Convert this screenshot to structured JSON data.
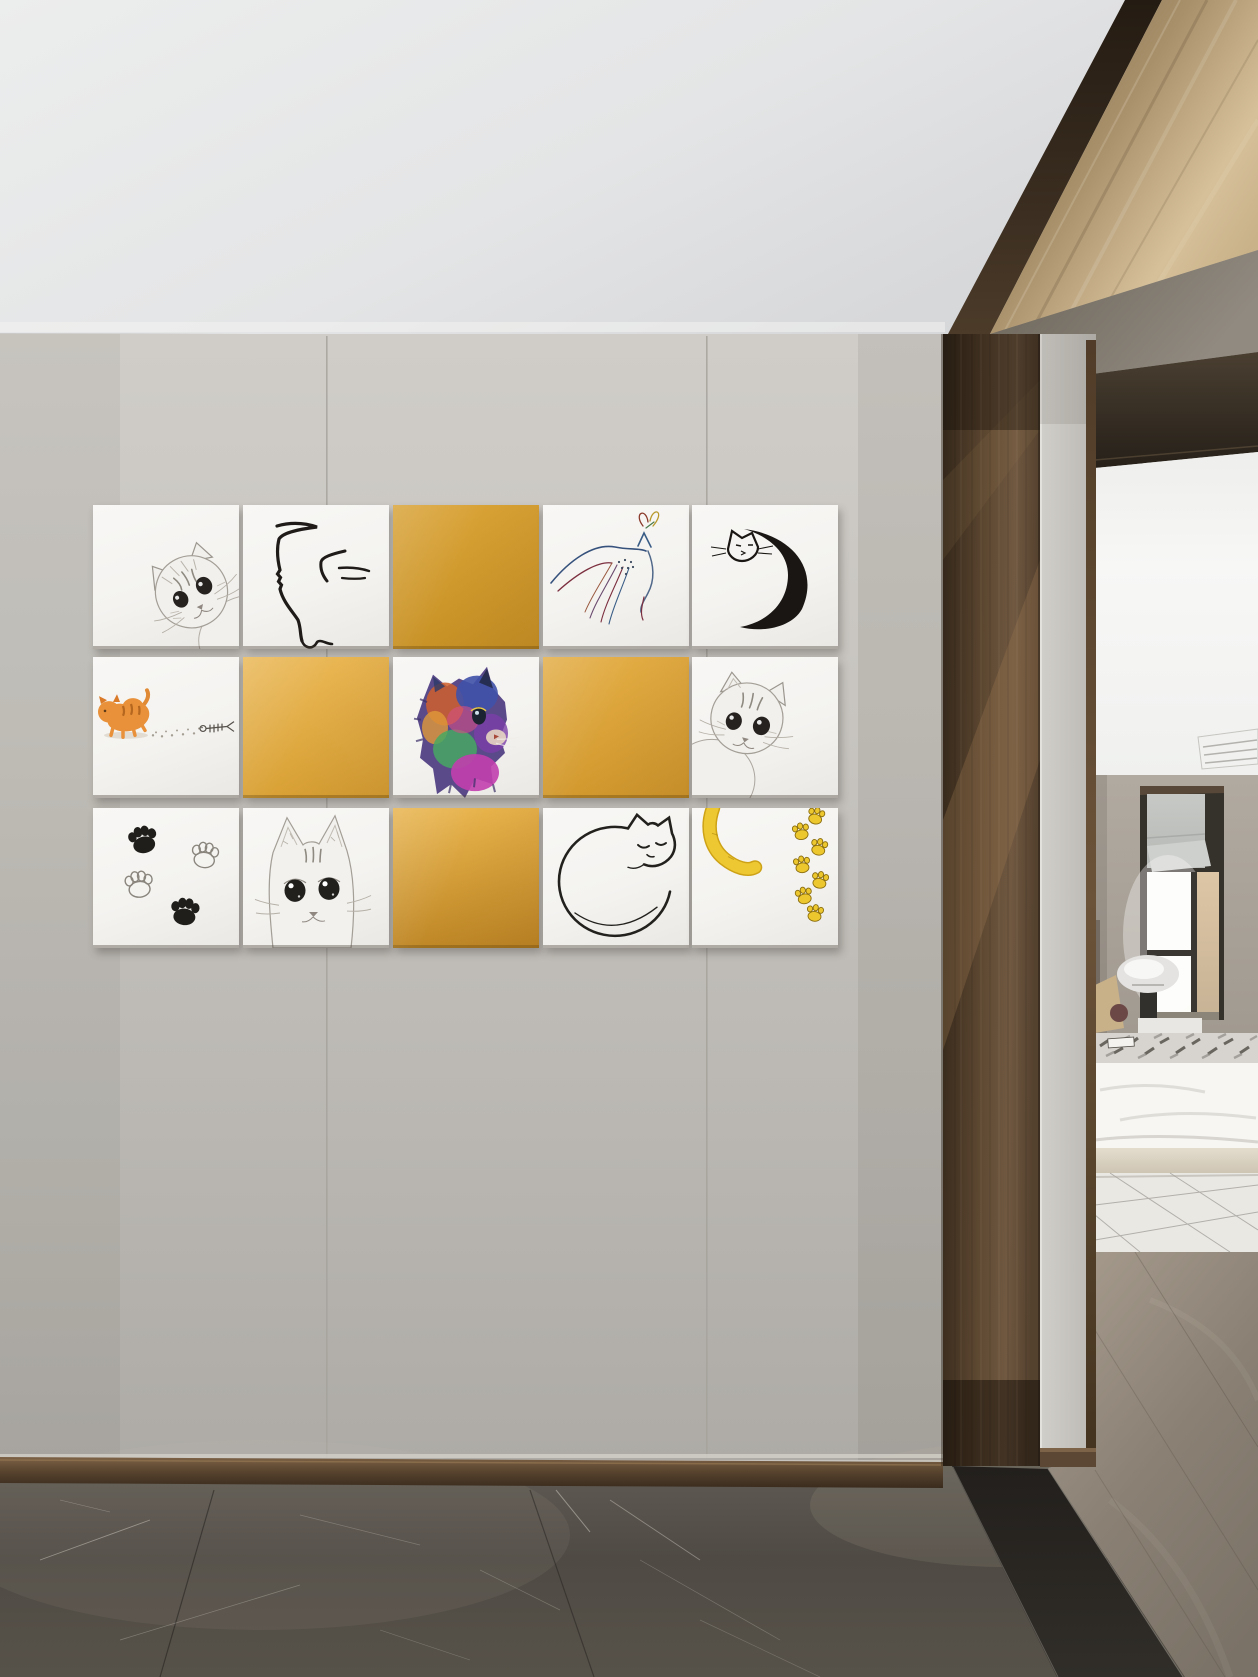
{
  "palette": {
    "wall": "#c6c3be",
    "ceiling": "#e9eaec",
    "accent_yellow": "#e0a83e",
    "bronze": "#6e5740",
    "bronze_dark": "#3a2d20",
    "marble_floor": "#534e48",
    "threshold_black": "#26231f",
    "wood_floor": "#8d8276",
    "bedroom_wall": "#aaa49c",
    "white_tile": "#f5f4f1",
    "line_ink": "#1e1b18",
    "sketch_gray": "#8f8a82",
    "rug": "#eae8e3",
    "duvet": "#f7f6f3"
  },
  "art_wall": {
    "grid": {
      "cols_x": [
        93,
        243,
        393,
        543,
        692
      ],
      "rows_y": [
        505,
        657,
        808
      ],
      "tile_w": 146,
      "row_h": [
        144,
        141,
        140
      ]
    },
    "tiles": [
      {
        "id": "r1c1",
        "row": 0,
        "col": 0,
        "type": "art",
        "art": "sketch-cat-corner",
        "label": "pencil sketch kitten peeking from corner"
      },
      {
        "id": "r1c2",
        "row": 0,
        "col": 1,
        "type": "art",
        "art": "line-cat-profile",
        "label": "minimal ink cat profile"
      },
      {
        "id": "r1c3",
        "row": 0,
        "col": 2,
        "type": "solid",
        "fill_top": "#d8a134",
        "fill_bottom": "#c89226",
        "label": "solid amber tile"
      },
      {
        "id": "r1c4",
        "row": 0,
        "col": 3,
        "type": "art",
        "art": "rainbow-line-cat-butterfly",
        "label": "colored line cat watching butterfly"
      },
      {
        "id": "r1c5",
        "row": 0,
        "col": 4,
        "type": "art",
        "art": "crescent-cat",
        "label": "cat curled as crescent moon"
      },
      {
        "id": "r2c1",
        "row": 1,
        "col": 0,
        "type": "art",
        "art": "orange-kitten-fish",
        "label": "orange kitten with paw trail to fish bone"
      },
      {
        "id": "r2c2",
        "row": 1,
        "col": 1,
        "type": "solid",
        "fill_top": "#e9b653",
        "fill_bottom": "#d9a135",
        "label": "solid amber tile"
      },
      {
        "id": "r2c3",
        "row": 1,
        "col": 2,
        "type": "art",
        "art": "rainbow-watercolor-kitten",
        "label": "rainbow watercolor kitten"
      },
      {
        "id": "r2c4",
        "row": 1,
        "col": 3,
        "type": "solid",
        "fill_top": "#e2ab42",
        "fill_bottom": "#d2992e",
        "label": "solid amber tile"
      },
      {
        "id": "r2c5",
        "row": 1,
        "col": 4,
        "type": "art",
        "art": "sketch-cat-peek-left",
        "label": "pencil sketch cat tilting head"
      },
      {
        "id": "r3c1",
        "row": 2,
        "col": 0,
        "type": "art",
        "art": "paw-prints-black",
        "label": "black and outline paw prints"
      },
      {
        "id": "r3c2",
        "row": 2,
        "col": 1,
        "type": "art",
        "art": "sketch-cat-bottom",
        "label": "pencil sketch cat rising from edge"
      },
      {
        "id": "r3c3",
        "row": 2,
        "col": 2,
        "type": "solid",
        "fill_top": "#e7b24a",
        "fill_bottom": "#bf8726",
        "label": "solid amber tile"
      },
      {
        "id": "r3c4",
        "row": 2,
        "col": 3,
        "type": "art",
        "art": "curled-sleeping-cat",
        "label": "line art sleeping cat curled in circle"
      },
      {
        "id": "r3c5",
        "row": 2,
        "col": 4,
        "type": "art",
        "art": "yellow-tail-paws",
        "label": "yellow tail and paw print trail"
      }
    ]
  },
  "scene": {
    "wall_panel_seams": 2,
    "elements": [
      "white ceiling",
      "bronze ceiling beam",
      "gray wall panels",
      "bronze pilaster",
      "door jamb",
      "door soffit",
      "bedroom view",
      "recessed window",
      "roman shade",
      "table lamp",
      "pillows",
      "nightstand",
      "patterned throw",
      "white duvet",
      "bed base",
      "patterned rug",
      "wood floor",
      "ceiling vent",
      "dark marble floor",
      "black threshold strip",
      "bronze baseboard"
    ]
  }
}
